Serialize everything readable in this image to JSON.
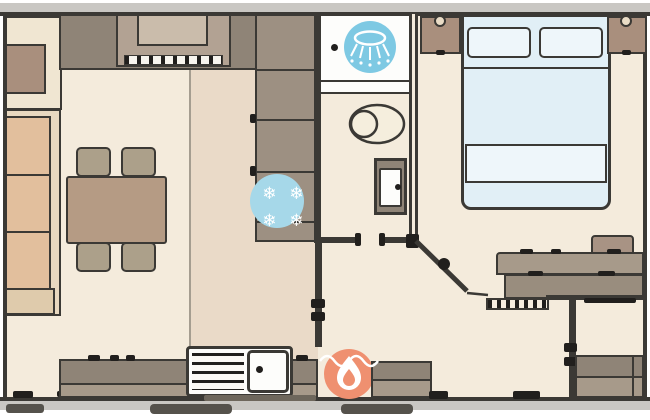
{
  "plan": {
    "type": "static-caravan-floorplan",
    "icons": {
      "shower": "shower-spray",
      "freezer_snowflakes": [
        "❄",
        "❄",
        "❄",
        "❄"
      ],
      "heater": "flame"
    },
    "colors": {
      "page": "#ffffff",
      "outerBand": "#c9c7c3",
      "wall": "#3b3935",
      "stripeDark": "#211f1d",
      "floor": "#f4ebdc",
      "floorKitchen": "#eadac8",
      "counter": "#8f8477",
      "counterLight": "#a79a8a",
      "unit": "#9d9082",
      "cabinet": "#a98f7d",
      "sideboard": "#f0e6d2",
      "cooker": "#b2a293",
      "cookerRecess": "#cabcab",
      "sofaSeat": "#e2bf9d",
      "sofaBack": "#e8d8c0",
      "sofaArm": "#dfcbac",
      "table": "#b59b84",
      "chair": "#aca08a",
      "stool": "#a89384",
      "dresserFront": "#998d7e",
      "headboard": "#b3a797",
      "bedLinen": "#e1eff6",
      "bedLinenLight": "#eef6fa",
      "handle": "#e9dcc6",
      "showerBlue": "#7ec9e3",
      "freezerBlue": "#a6d8e9",
      "heaterOrange": "#ef9070",
      "white": "#fdfdfb",
      "step": "#55524c"
    },
    "rooms": {
      "lounge": [
        "sideboard",
        "tv-unit",
        "corner-sofa",
        "dining-table",
        "dining-chairs"
      ],
      "kitchen": [
        "worktop",
        "cooker",
        "tall-units",
        "fridge-freezer",
        "sink-drainer"
      ],
      "shower_room": [
        "shower-tray",
        "toilet",
        "wash-basin"
      ],
      "bedroom": [
        "double-bed",
        "bedside-cabinets",
        "dressing-table",
        "stool"
      ],
      "hallway": [
        "gas-heater",
        "bench",
        "wardrobe"
      ]
    }
  }
}
